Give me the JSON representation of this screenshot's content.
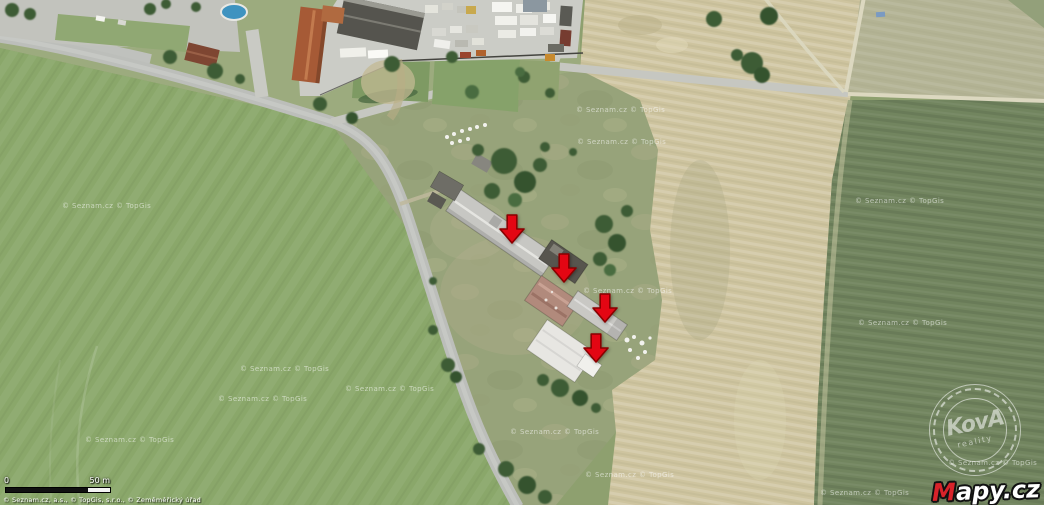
{
  "map": {
    "watermark_text": "© Seznam.cz  © TopGis",
    "watermarks": [
      {
        "x": 62,
        "y": 202
      },
      {
        "x": 576,
        "y": 106
      },
      {
        "x": 577,
        "y": 138
      },
      {
        "x": 855,
        "y": 197
      },
      {
        "x": 583,
        "y": 287
      },
      {
        "x": 858,
        "y": 319
      },
      {
        "x": 948,
        "y": 459
      },
      {
        "x": 820,
        "y": 489
      },
      {
        "x": 585,
        "y": 471
      },
      {
        "x": 510,
        "y": 428
      },
      {
        "x": 345,
        "y": 385
      },
      {
        "x": 240,
        "y": 365
      },
      {
        "x": 218,
        "y": 395
      },
      {
        "x": 85,
        "y": 436
      }
    ],
    "arrow_color": "#e30613",
    "arrow_outline": "#8a0000",
    "arrows": [
      {
        "x": 512,
        "y": 243
      },
      {
        "x": 564,
        "y": 282
      },
      {
        "x": 605,
        "y": 322
      },
      {
        "x": 596,
        "y": 362
      }
    ]
  },
  "stamp": {
    "brand": "KovA",
    "subtitle": "reality"
  },
  "logo": {
    "text": "Mapy.cz",
    "accent_color": "#d8232a"
  },
  "scalebar": {
    "start_label": "0",
    "end_label": "50 m"
  },
  "attribution": {
    "text": "© Seznam.cz, a.s., © TopGis, s.r.o., © Zeměměřický úřad"
  },
  "palette": {
    "meadow_green": "#8aa76a",
    "scrub_green": "#97a37a",
    "dry_field_tan": "#cec49f",
    "crop_field_olive": "#72855f",
    "road_gray": "#bcbeba",
    "tree_green": "#3d5c36",
    "roof_gray": "#c7c7c3",
    "roof_red": "#a65a36"
  }
}
